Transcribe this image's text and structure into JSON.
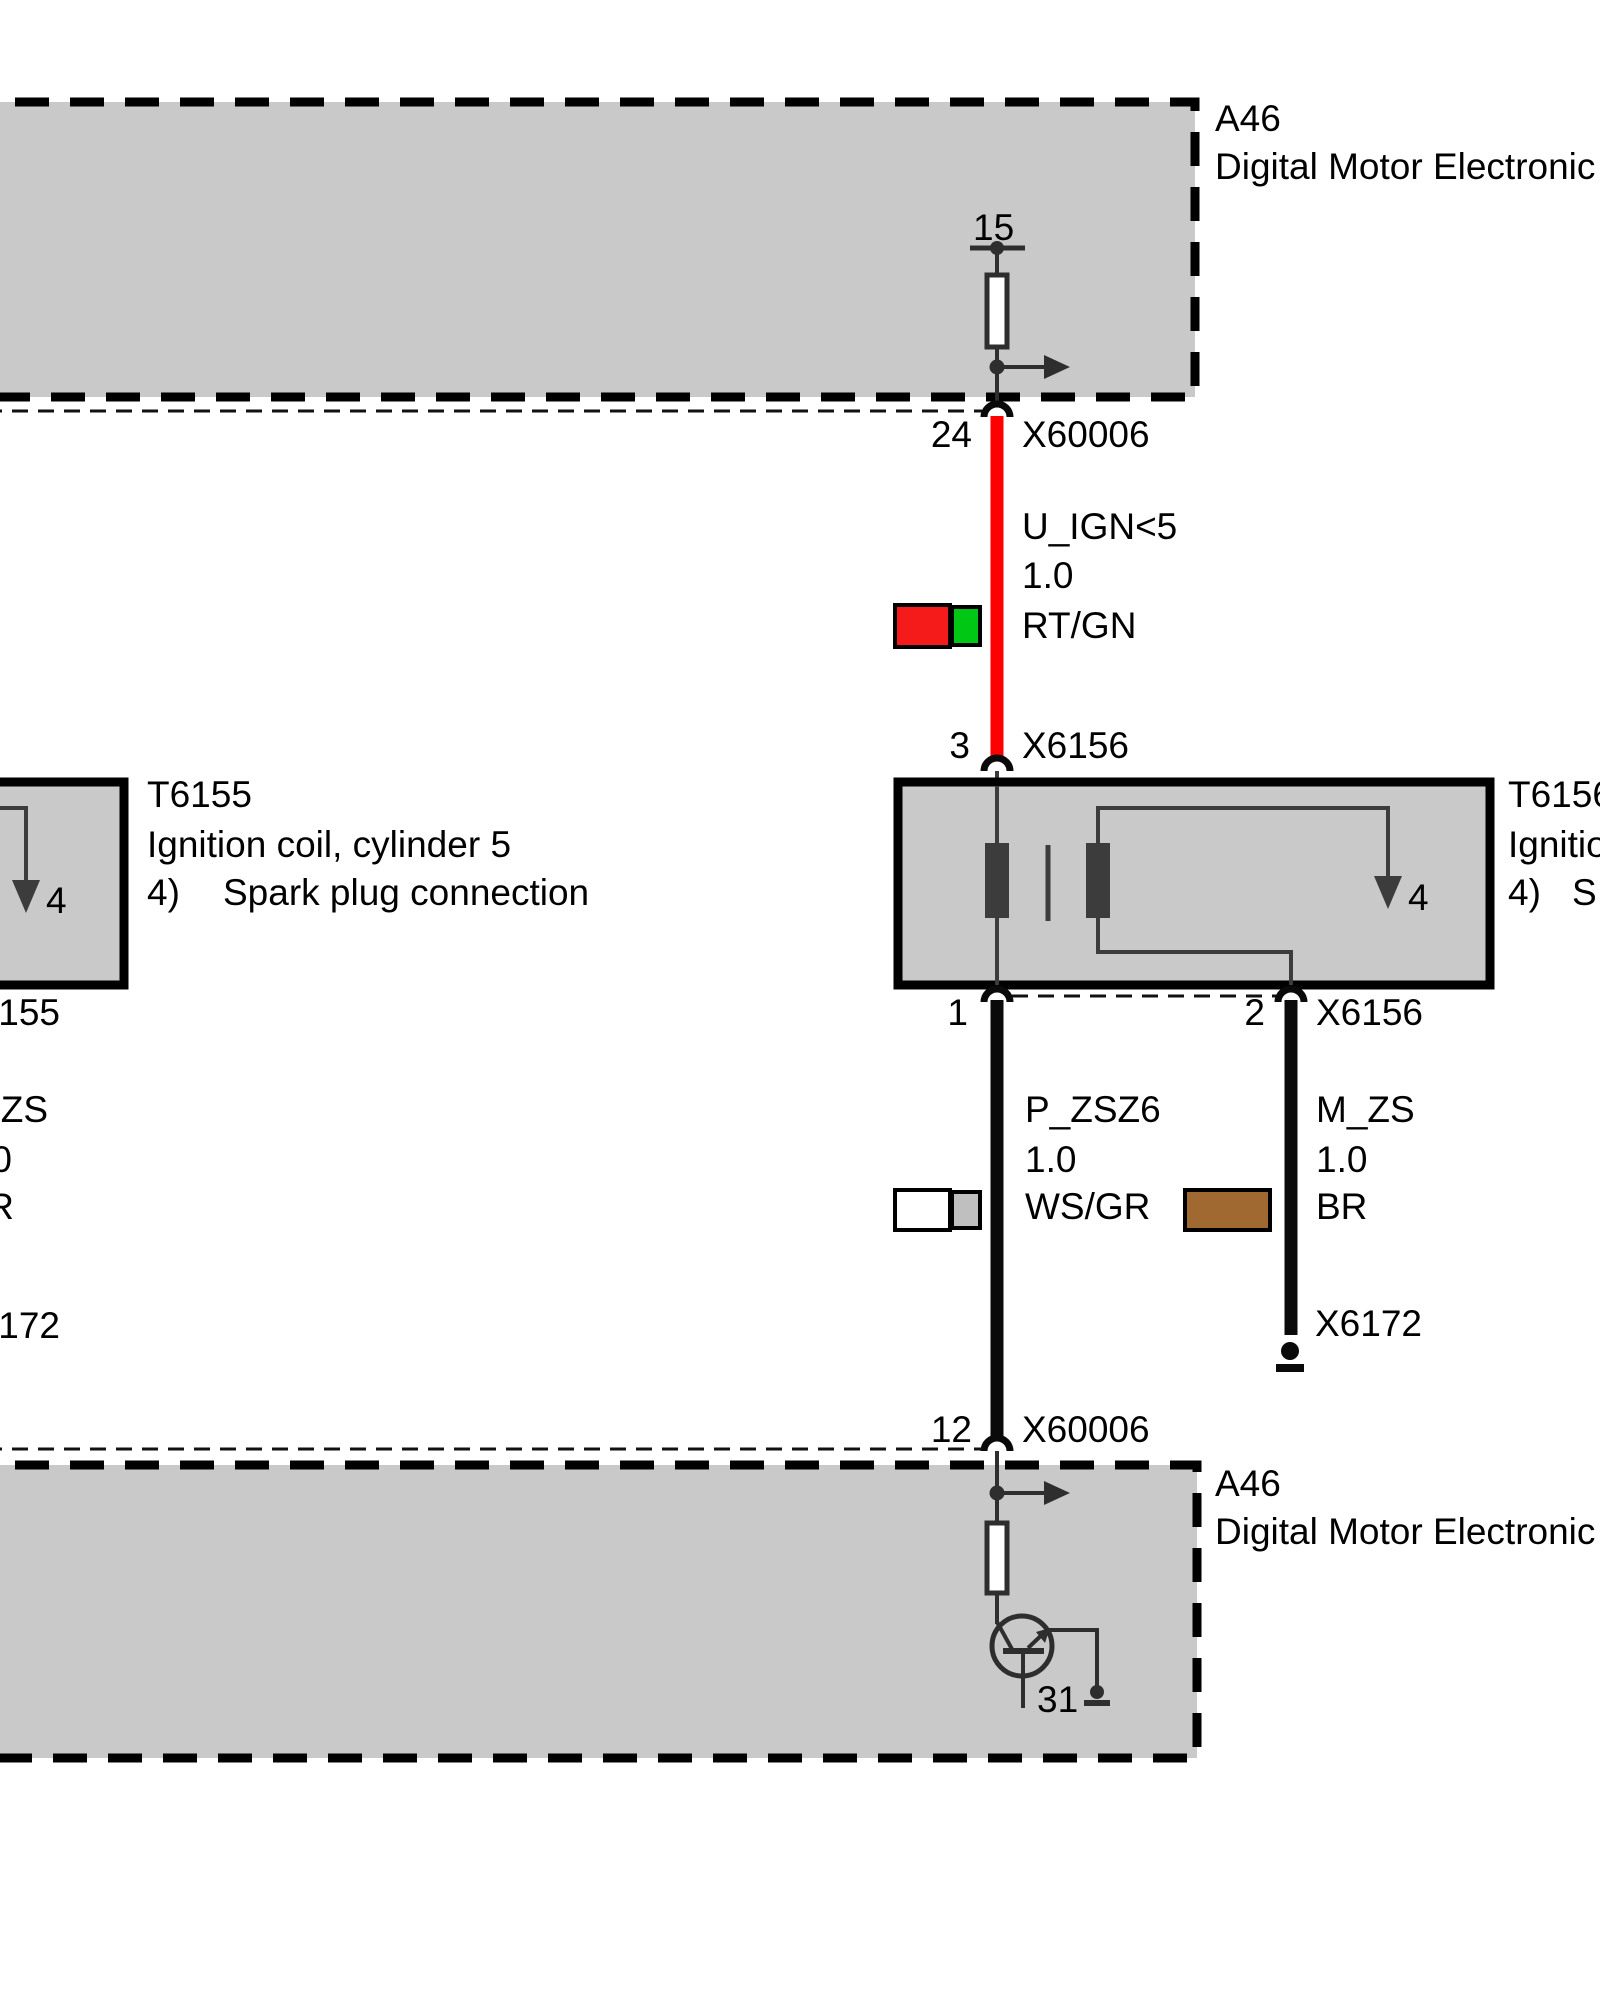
{
  "palette": {
    "module_fill": "#C9C9C9",
    "module_border": "#000000",
    "wire_red": "#FF0000",
    "wire_black": "#0A0A0A",
    "symbol_stroke": "#2E2E2E",
    "coil_stroke": "#3C3C3C",
    "swatch_red": "#F51B1B",
    "swatch_green": "#00C713",
    "swatch_white": "#FFFFFF",
    "swatch_gray": "#BFBFBF",
    "swatch_brown": "#A06932"
  },
  "top_module": {
    "id": "A46",
    "name": "Digital Motor Electronic",
    "terminal_15": "15",
    "pin": "24",
    "connector": "X60006"
  },
  "ign_wire": {
    "signal": "U_IGN<5",
    "size": "1.0",
    "code": "RT/GN"
  },
  "coil_connector": {
    "pin_in": "3",
    "name": "X6156",
    "pin1": "1",
    "pin2": "2",
    "name_bottom": "X6156"
  },
  "coil_right": {
    "id": "T6156",
    "line2": "Ignitio",
    "note_prefix": "4)",
    "note_text": "S",
    "spark_pin": "4"
  },
  "coil_left": {
    "id": "T6155",
    "line2": "Ignition coil, cylinder 5",
    "note_prefix": "4)",
    "note_text": "Spark plug connection",
    "spark_pin": "4"
  },
  "p_wire": {
    "signal": "P_ZSZ6",
    "size": "1.0",
    "code": "WS/GR"
  },
  "m_wire": {
    "signal": "M_ZS",
    "size": "1.0",
    "code": "BR"
  },
  "ground_right": {
    "name": "X6172"
  },
  "edge_fragments": {
    "x6155": "155",
    "m_zs": "ZS",
    "size": "0",
    "code": "R",
    "x6172": "172"
  },
  "bottom_module": {
    "id": "A46",
    "name": "Digital Motor Electronic",
    "pin": "12",
    "connector": "X60006",
    "terminal_31": "31"
  }
}
